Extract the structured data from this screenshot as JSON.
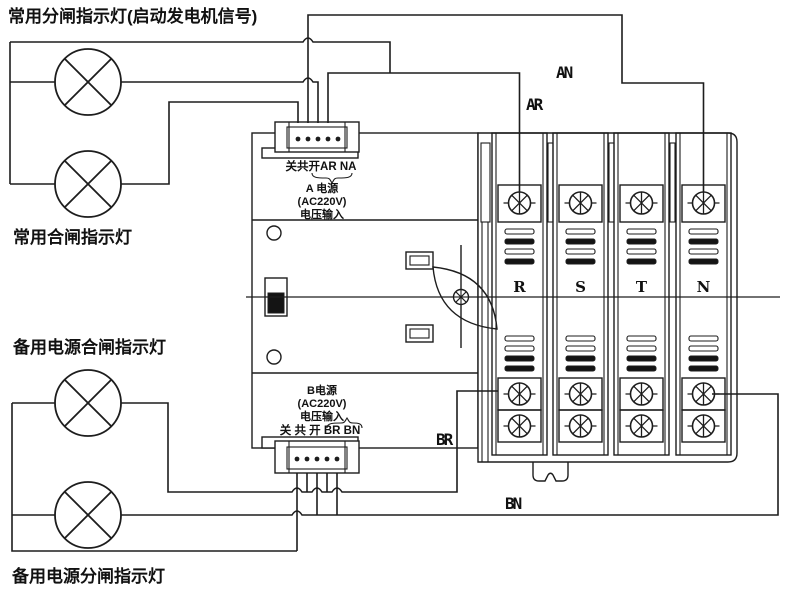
{
  "labels": {
    "lamp1": "常用分闸指示灯(启动发电机信号)",
    "lamp2": "常用合闸指示灯",
    "lamp3": "备用电源合闸指示灯",
    "lamp4": "备用电源分闸指示灯"
  },
  "block_a": {
    "terminal_row": "关共开AR  NA",
    "source": "A 电源",
    "voltage": "(AC220V)",
    "input": "电压输入"
  },
  "block_b": {
    "source": "B电源",
    "voltage": "(AC220V)",
    "input": "电压输入",
    "terminal_row": "关 共 开 BR BN"
  },
  "wires": {
    "an": "AN",
    "ar": "AR",
    "br": "BR",
    "bn": "BN"
  },
  "poles": [
    {
      "label": "R"
    },
    {
      "label": "S"
    },
    {
      "label": "T"
    },
    {
      "label": "N"
    }
  ],
  "terminal_counts": {
    "block_a_dots": 5,
    "block_b_dots": 5
  },
  "colors": {
    "line": "#1d1d1d",
    "background": "#ffffff"
  }
}
